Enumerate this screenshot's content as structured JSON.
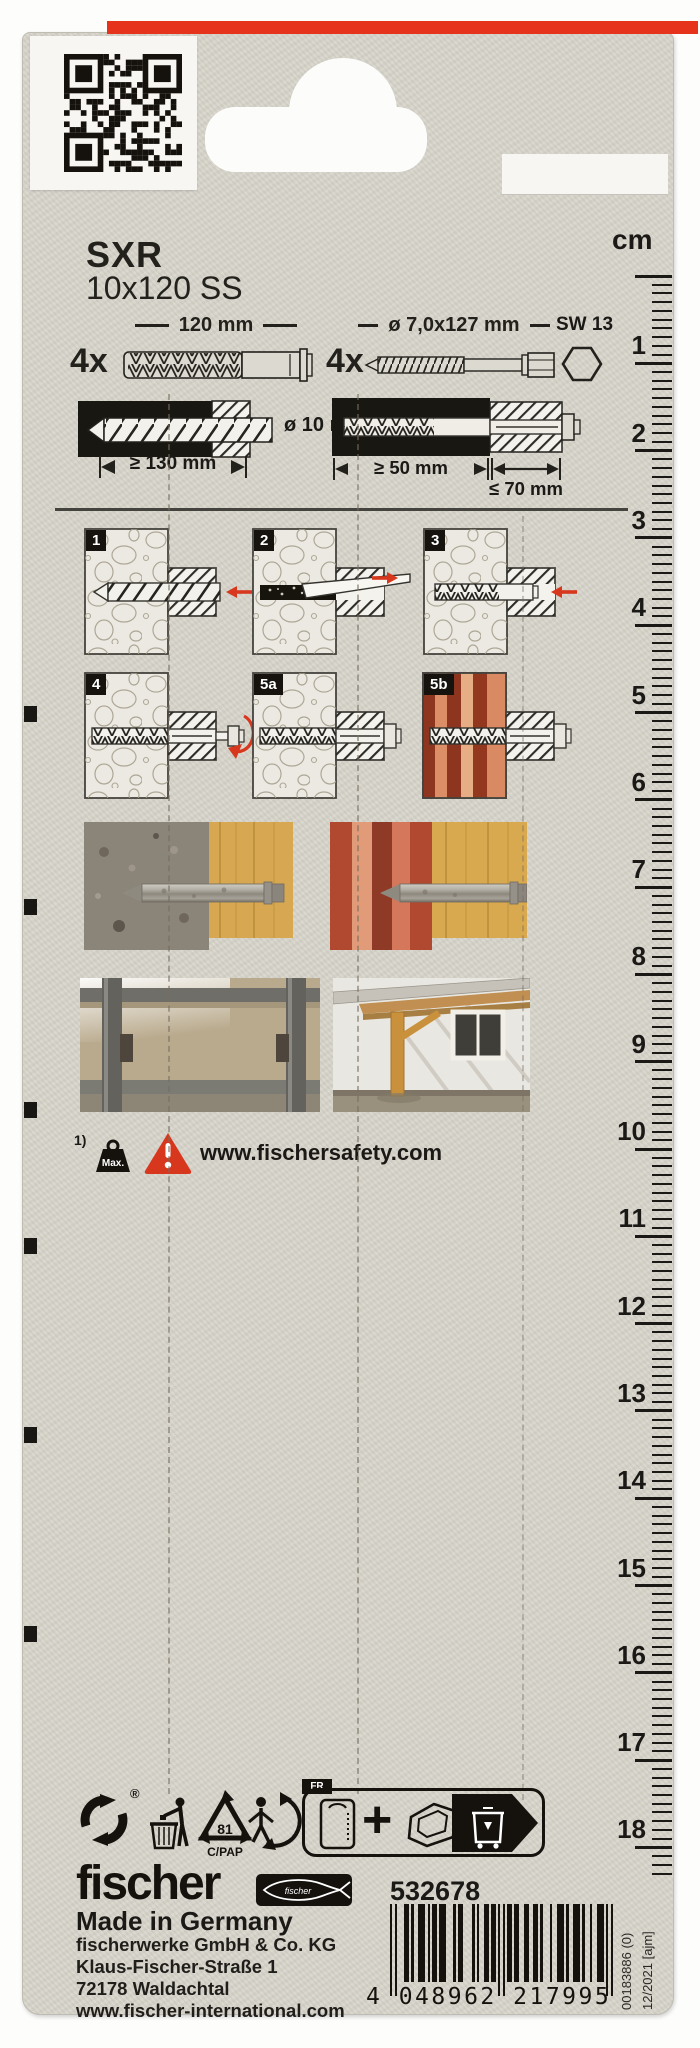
{
  "product": {
    "name": "SXR",
    "size": "10x120 SS"
  },
  "ruler": {
    "unit": "cm",
    "first": 1,
    "last": 18
  },
  "contents": {
    "plug_qty": "4x",
    "plug_length": "120 mm",
    "screw_qty": "4x",
    "screw_dims": "ø 7,0x127 mm",
    "wrench_size": "SW 13"
  },
  "install": {
    "drill_diameter": "ø 10 mm",
    "drill_depth": "≥ 130 mm",
    "anchor_depth": "≥ 50 mm",
    "fixture_max": "≤ 70 mm"
  },
  "steps": [
    {
      "label": "1"
    },
    {
      "label": "2"
    },
    {
      "label": "3"
    },
    {
      "label": "4"
    },
    {
      "label": "5a"
    },
    {
      "label": "5b"
    }
  ],
  "safety": {
    "footnote": "1)",
    "max_label": "Max.",
    "url": "www.fischersafety.com"
  },
  "recycling": {
    "registered": "®",
    "pap_code": "81",
    "pap_material": "C/PAP",
    "fr_label": "FR",
    "plus_sign": "+"
  },
  "footer": {
    "brand": "fischer",
    "article_no": "532678",
    "origin": "Made in Germany",
    "address_1": "fischerwerke GmbH & Co. KG",
    "address_2": "Klaus-Fischer-Straße 1",
    "address_3": "72178 Waldachtal",
    "address_4": "www.fischer-international.com",
    "ean_text": "4 048962 217995",
    "print_code": "00183886 (0)",
    "print_date": "12/2021 [ajm]"
  },
  "colors": {
    "brand_red": "#e5341b",
    "card_bg": "#d8d5cc",
    "ink": "#1b1916",
    "warning_red": "#d7371d"
  }
}
